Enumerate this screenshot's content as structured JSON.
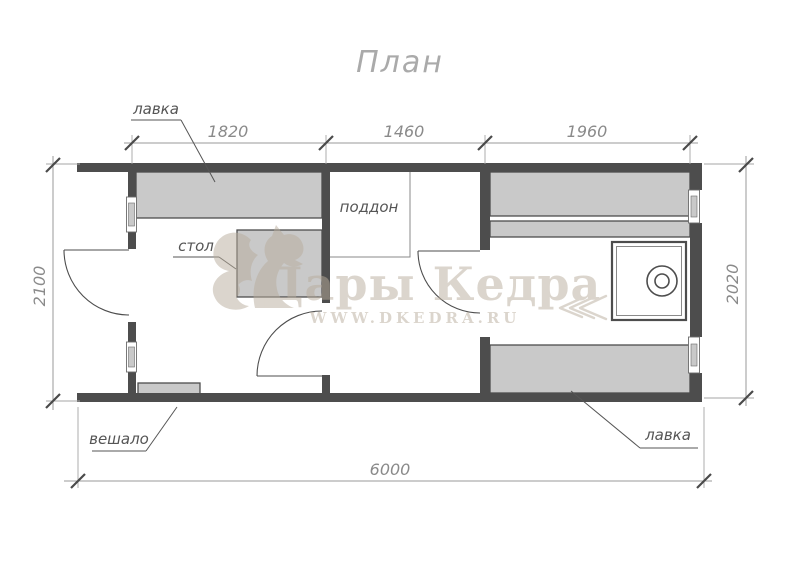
{
  "title": "План",
  "dimensions": {
    "top_segments": [
      "1820",
      "1460",
      "1960"
    ],
    "left": "2100",
    "right": "2020",
    "bottom": "6000"
  },
  "labels": {
    "bench_top": "лавка",
    "table": "стол",
    "shower_tray": "поддон",
    "hanger": "вешало",
    "bench_bottom": "лавка"
  },
  "watermark": {
    "brand": "Дары Кедра",
    "website": "WWW.DKEDRA.RU"
  },
  "colors": {
    "wall": "#4d4d4d",
    "furniture_fill": "#c9c9c9",
    "dimension_line": "#9a9a9a",
    "dimension_text": "#8a8a8a",
    "label_text": "#555555",
    "title_text": "#aaaaaa",
    "watermark": "#b9ad9c"
  }
}
